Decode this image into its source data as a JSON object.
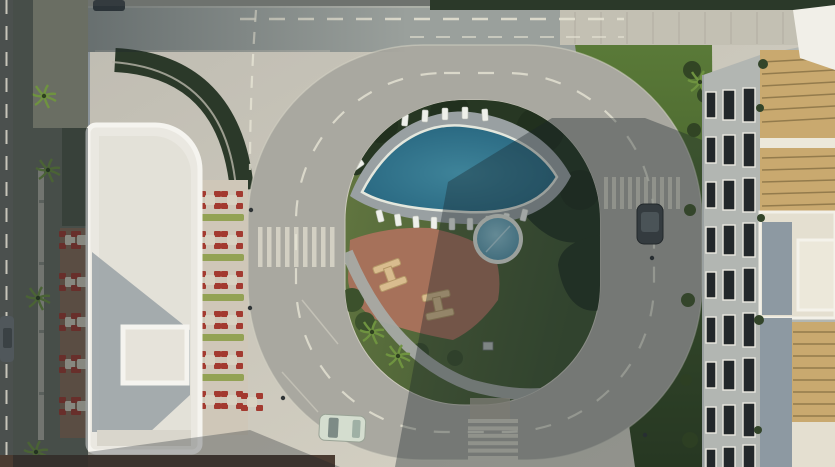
{
  "scene": {
    "type": "aerial-architectural-render",
    "view": "top-down daytime 3D visualization of a residential complex",
    "elements": {
      "left_building": "white flat-roof building with raised rooftop skylight",
      "left_tower": "white tower block with facade windows at top-left",
      "right_building": "apartment building with window facade and rooftop pergola terraces",
      "main_pool": "lens-shaped swimming pool ringed by sun loungers",
      "kids_pool": "small circular pool",
      "playground": "terracotta play area with two climbing frames",
      "loop_road": "oval internal road with dashed lane markings",
      "top_road": "horizontal road along top edge",
      "west_road": "dark road along left edge",
      "crosswalk_count": 3,
      "car_count": 4,
      "outdoor_dining": "rows of tables with red chairs and green planters",
      "palm_trees": "palms along west sidewalk, courtyard and lawns",
      "lawn": "green lawns inside loop and along east building",
      "canopy": "white sail canopy at top-right corner"
    }
  },
  "colors": {
    "pavement": "#c8c4b8",
    "pavementBright": "#d9d5c7",
    "road": "#a9a8a0",
    "roadTop": "#9aa09c",
    "leftRoad": "#4b504e",
    "dash": "#e6e3d4",
    "curb": "#d6d3c5",
    "crosswalk": "#d7d4c6",
    "sidewalkTick": "#a8a59a",
    "walkStrip": "#6a6e63",
    "walkPath": "#b4b2a6",
    "hedge": "#2b3929",
    "treeDark": "#1f2d1c",
    "trees": "#273723",
    "lawnLight": "#647841",
    "lawnDark": "#3f5531",
    "lawnRightTop": "#5a7a38",
    "lawnRightBottom": "#2f431f",
    "poolDeep": "#23607a",
    "poolLight": "#4d93a7",
    "poolRim": "#e4e7dd",
    "deck": "#99a0a2",
    "lounger": "#eef0ea",
    "kidsPool": "#62a5ba",
    "playground": "#a6715a",
    "frameTan": "#d9bc8e",
    "frameEdge": "#b49767",
    "pathGray": "#a6aaa5",
    "buildingWhite": "#eae8e1",
    "parapet": "#f5f4ef",
    "roofInner": "#e3e1d8",
    "roofShade": "#99a1a6",
    "skylight": "#e6e3da",
    "roofBottomBand": "#d9d6cc",
    "towerWall": "#e2e2dc",
    "towerSide": "#8b949b",
    "glassDark": "#2f3539",
    "winFrame": "#eceae2",
    "facade": "#b2b6b2",
    "winGlass": "#23282b",
    "roofCream": "#e4dfd0",
    "roofWhite": "#ece8da",
    "pergola": "#c9a96f",
    "pergolaSlat": "#8a7347",
    "roofBlue": "#8d99a2",
    "canopy": "#f1efe8",
    "chairRed": "#a33a30",
    "tableTop": "#d8d2c2",
    "planter": "#93a254",
    "diningDeck": "#cfc7b8",
    "woodDeck": "#8a6d58",
    "palmFrond": "#6f9340",
    "palmCore": "#2e401f",
    "bushGreen": "#3c512c",
    "carWhite": "#d4ddcf",
    "carWhiteGlass": "#7d8b86",
    "carDark": "#343b3f",
    "carDarkRoof": "#4a5357",
    "carGray": "#50575b",
    "carGrayRoof": "#3a4144",
    "lamp": "#2f3436",
    "brownStrip": "#4a3b31",
    "shadow": "rgba(26,36,42,0.36)",
    "shadowLeft": "rgba(25,33,38,0.42)",
    "shadowSoft": "rgba(26,34,40,0.30)"
  }
}
